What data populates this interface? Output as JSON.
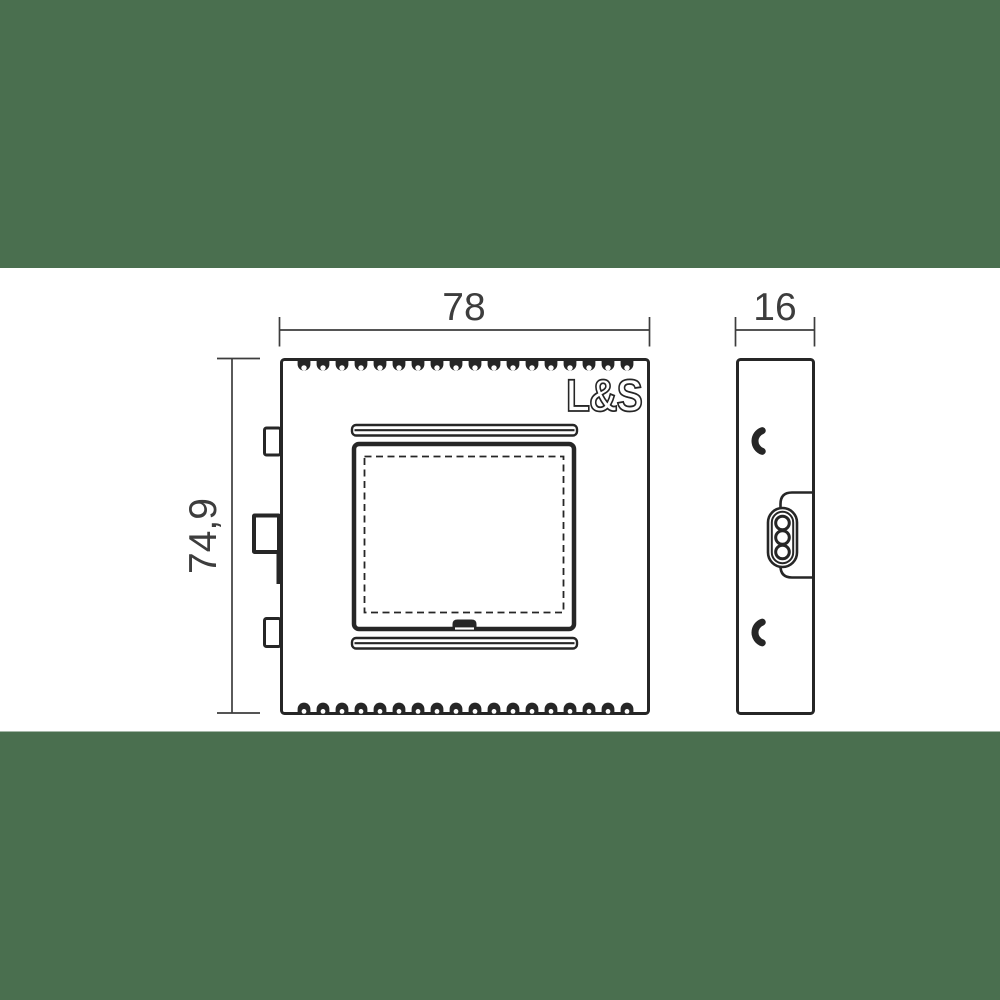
{
  "colors": {
    "background_band": "#4a6f4f",
    "canvas": "#ffffff",
    "line": "#262626",
    "dimension": "#3d3d3d"
  },
  "logo": {
    "text": "L&S"
  },
  "dimensions": {
    "front_width": "78",
    "front_height": "74,9",
    "side_depth": "16"
  }
}
